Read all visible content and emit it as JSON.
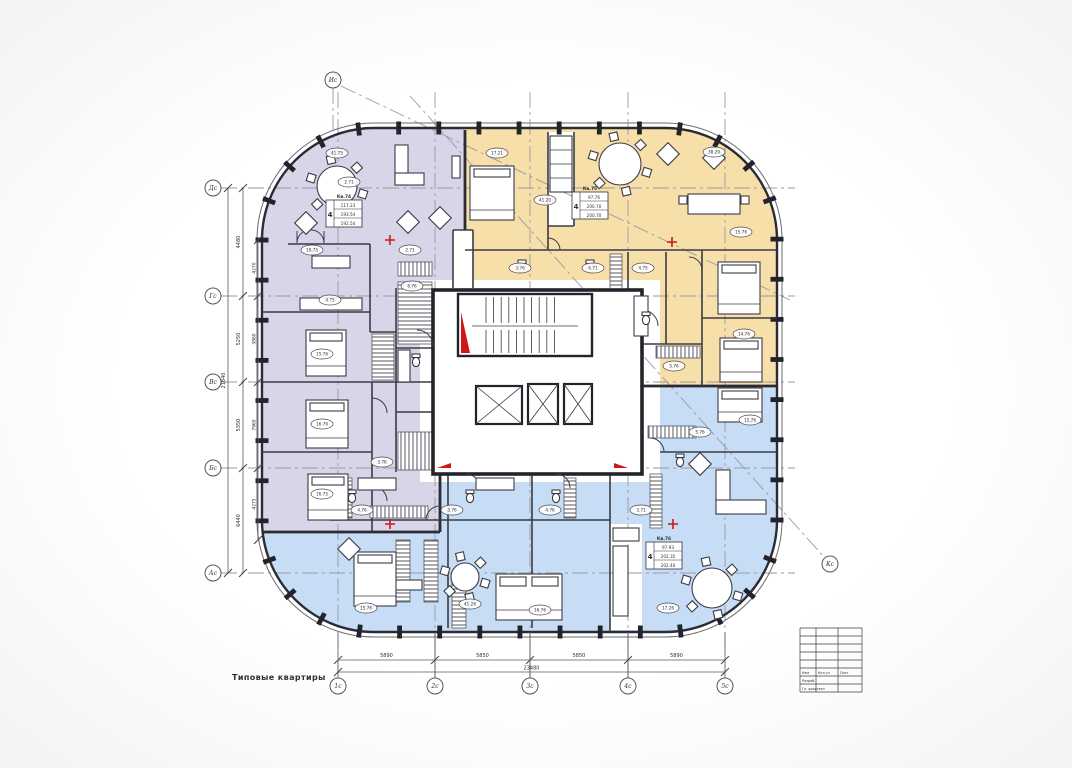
{
  "note_label": "Типовые квартиры",
  "palette": {
    "purple": "#d8d5e8",
    "yellow": "#f7dfa9",
    "blue": "#c6ddf5",
    "wall": "#2b2b33",
    "red": "#cf1715",
    "axis_gray": "#9a9aa2",
    "dim_gray": "#5b5b64",
    "paper": "#ffffff"
  },
  "axes": {
    "left": [
      {
        "label": "Дс",
        "y": 188
      },
      {
        "label": "Гс",
        "y": 296
      },
      {
        "label": "Вс",
        "y": 382
      },
      {
        "label": "Бс",
        "y": 468
      },
      {
        "label": "Ас",
        "y": 573
      }
    ],
    "bottom": [
      {
        "label": "1с",
        "x": 338
      },
      {
        "label": "2с",
        "x": 435
      },
      {
        "label": "3с",
        "x": 530
      },
      {
        "label": "4с",
        "x": 628
      },
      {
        "label": "5с",
        "x": 725
      }
    ],
    "diagonal": [
      {
        "label": "Ис",
        "x": 333,
        "y": 80
      },
      {
        "label": "Кс",
        "x": 830,
        "y": 564
      }
    ]
  },
  "dimensions": {
    "bottom_segments": [
      {
        "a": 338,
        "b": 435,
        "v": "5890"
      },
      {
        "a": 435,
        "b": 530,
        "v": "5850"
      },
      {
        "a": 530,
        "b": 628,
        "v": "5850"
      },
      {
        "a": 628,
        "b": 725,
        "v": "5890"
      }
    ],
    "bottom_total": {
      "a": 338,
      "b": 725,
      "v": "23480"
    },
    "left_segments": [
      {
        "a": 188,
        "b": 296,
        "v": "4480"
      },
      {
        "a": 296,
        "b": 382,
        "v": "5250"
      },
      {
        "a": 382,
        "b": 468,
        "v": "5350"
      },
      {
        "a": 468,
        "b": 573,
        "v": "6440"
      }
    ],
    "left_inner": [
      {
        "a": 240,
        "b": 296,
        "v": "4270"
      },
      {
        "a": 296,
        "b": 382,
        "v": "3860"
      },
      {
        "a": 382,
        "b": 468,
        "v": "7960"
      },
      {
        "a": 468,
        "b": 540,
        "v": "4275"
      }
    ],
    "left_total": {
      "a": 188,
      "b": 573,
      "v": "21840"
    }
  },
  "apartment_stamps": [
    {
      "zone": "purple",
      "x": 326,
      "y": 200,
      "rooms": "4",
      "header": "Кв.74",
      "rows": [
        "117.23",
        "193.54",
        "192.54"
      ]
    },
    {
      "zone": "yellow",
      "x": 572,
      "y": 192,
      "rooms": "4",
      "header": "Кв.75",
      "rows": [
        "97.76",
        "200.70",
        "200.70"
      ]
    },
    {
      "zone": "blue",
      "x": 646,
      "y": 542,
      "rooms": "4",
      "header": "Кв.76",
      "rows": [
        "97.93",
        "202.35",
        "202.40"
      ]
    }
  ],
  "room_labels": [
    {
      "x": 337,
      "y": 153,
      "v": "41.75"
    },
    {
      "x": 312,
      "y": 250,
      "v": "19.75"
    },
    {
      "x": 330,
      "y": 300,
      "v": "4.75"
    },
    {
      "x": 322,
      "y": 354,
      "v": "15.76"
    },
    {
      "x": 322,
      "y": 424,
      "v": "16.76"
    },
    {
      "x": 322,
      "y": 494,
      "v": "16.75"
    },
    {
      "x": 412,
      "y": 286,
      "v": "6.76"
    },
    {
      "x": 382,
      "y": 462,
      "v": "3.76"
    },
    {
      "x": 410,
      "y": 250,
      "v": "2.71"
    },
    {
      "x": 497,
      "y": 153,
      "v": "17.21"
    },
    {
      "x": 545,
      "y": 200,
      "v": "41.20"
    },
    {
      "x": 520,
      "y": 268,
      "v": "3.76"
    },
    {
      "x": 593,
      "y": 268,
      "v": "6.71"
    },
    {
      "x": 643,
      "y": 268,
      "v": "4.75"
    },
    {
      "x": 714,
      "y": 152,
      "v": "38.20"
    },
    {
      "x": 741,
      "y": 232,
      "v": "15.76"
    },
    {
      "x": 744,
      "y": 334,
      "v": "14.76"
    },
    {
      "x": 674,
      "y": 366,
      "v": "5.76"
    },
    {
      "x": 362,
      "y": 510,
      "v": "4.76"
    },
    {
      "x": 452,
      "y": 510,
      "v": "3.76"
    },
    {
      "x": 550,
      "y": 510,
      "v": "4.76"
    },
    {
      "x": 641,
      "y": 510,
      "v": "3.71"
    },
    {
      "x": 366,
      "y": 608,
      "v": "15.76"
    },
    {
      "x": 470,
      "y": 604,
      "v": "41.26"
    },
    {
      "x": 540,
      "y": 610,
      "v": "16.76"
    },
    {
      "x": 668,
      "y": 608,
      "v": "17.26"
    },
    {
      "x": 700,
      "y": 432,
      "v": "5.76"
    },
    {
      "x": 750,
      "y": 420,
      "v": "15.76"
    },
    {
      "x": 349,
      "y": 182,
      "v": "2.71"
    }
  ],
  "red_crosses": [
    {
      "x": 390,
      "y": 240
    },
    {
      "x": 672,
      "y": 242
    },
    {
      "x": 390,
      "y": 524
    },
    {
      "x": 673,
      "y": 524
    }
  ],
  "titleblock": {
    "row1": [
      "Изм",
      "Кол.уч",
      "Лист"
    ],
    "row2": [
      "Разраб.",
      ""
    ],
    "row3": [
      "Гл. архитект",
      ""
    ]
  }
}
